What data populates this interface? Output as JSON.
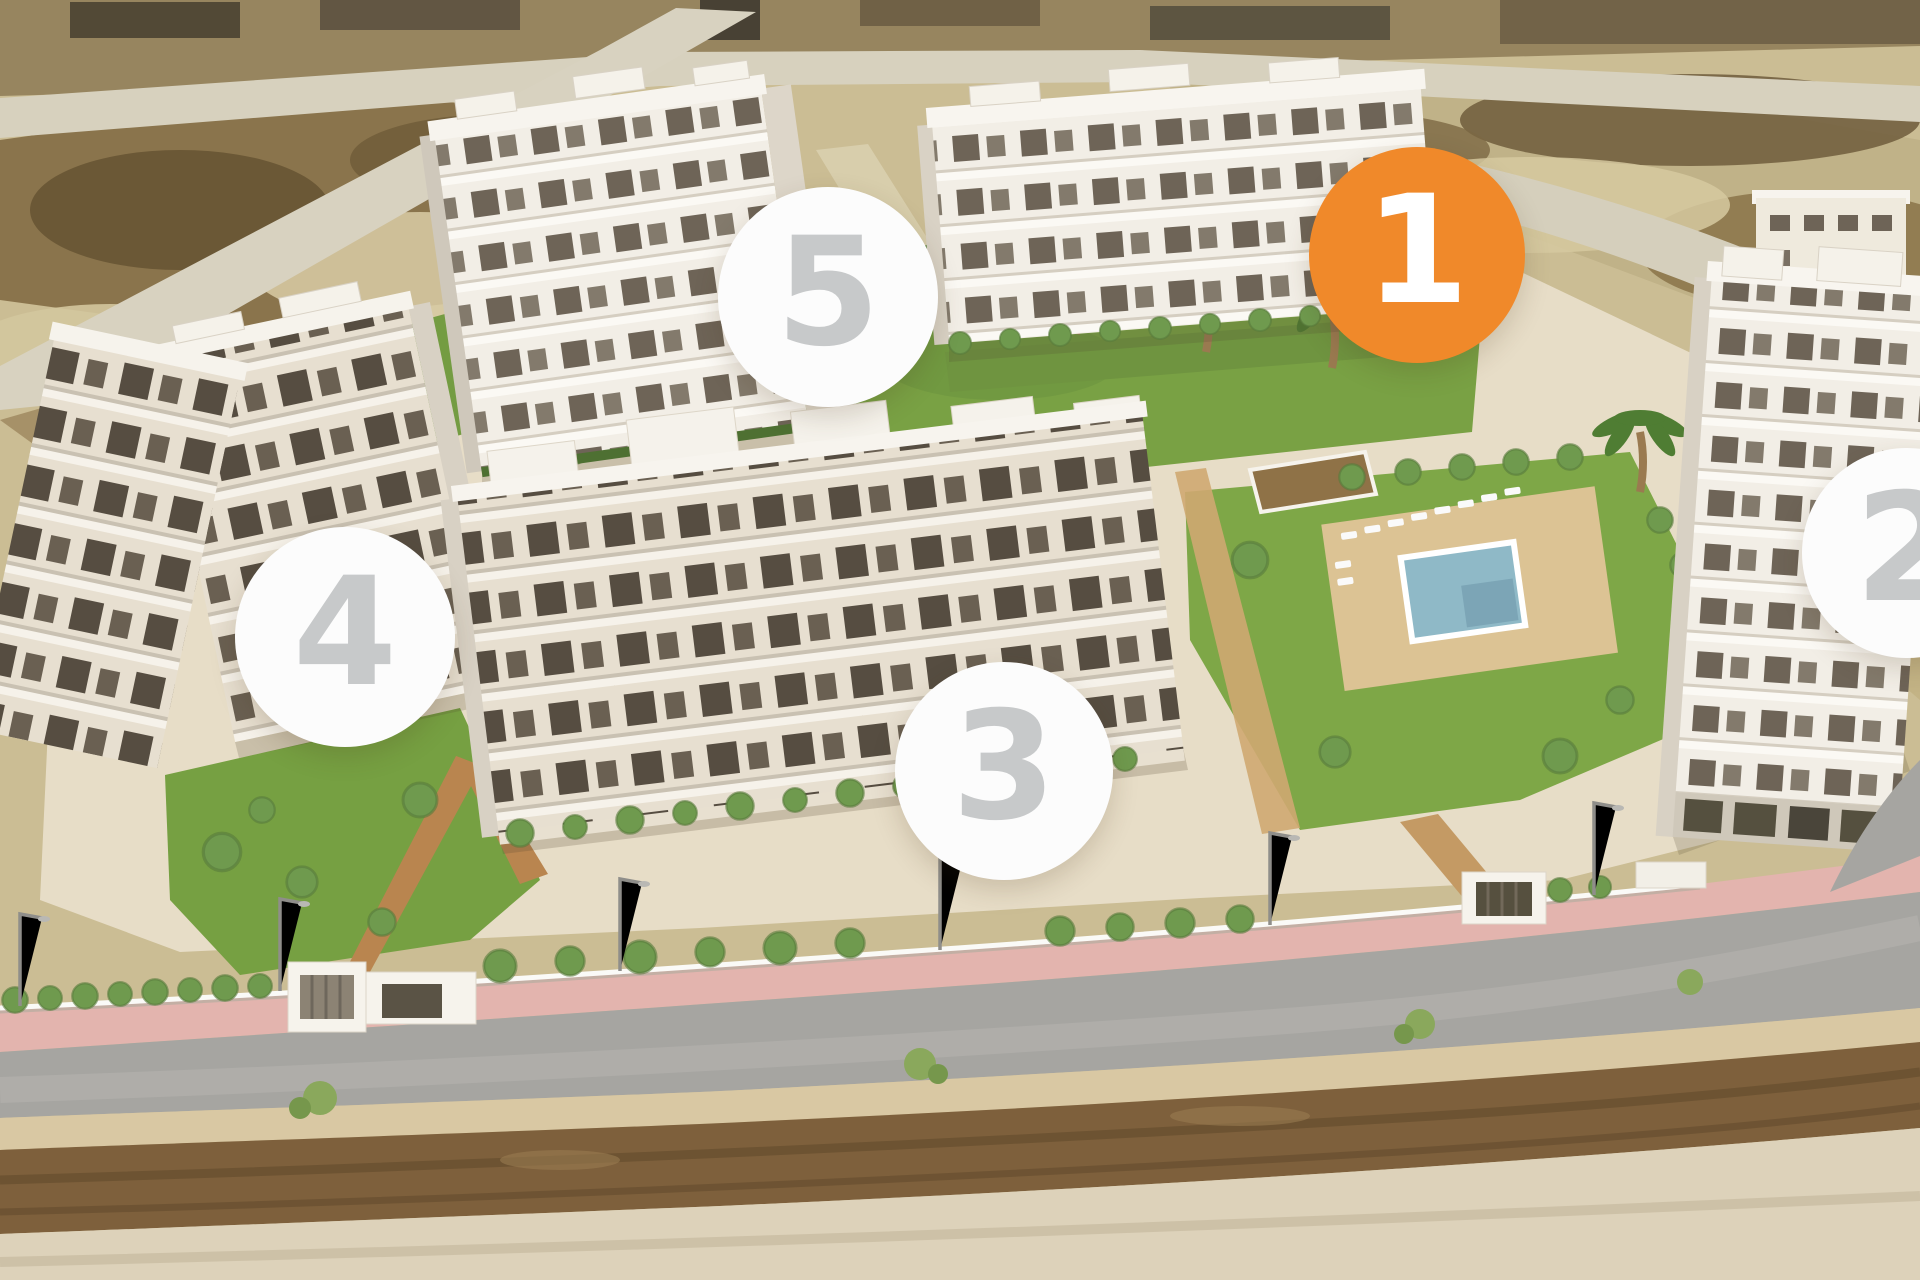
{
  "stage": {
    "width": 1920,
    "height": 1280
  },
  "palette": {
    "accent_orange": "#F0892A",
    "marker_white": "#FCFCFC",
    "marker_number_gray": "#C7C9CA",
    "lawn_green": "#79A144",
    "pool_blue": "#8FB9C7",
    "road_gray": "#A6A5A1",
    "sidewalk_pink": "#E3B4AE",
    "sand": "#CBBD94"
  },
  "markers": [
    {
      "id": "building-1",
      "number": "1",
      "selected": true,
      "bg": "#F0892A",
      "fg": "#FFFFFF",
      "cx": 1417,
      "cy": 255,
      "r": 108
    },
    {
      "id": "building-2",
      "number": "2",
      "selected": false,
      "bg": "#FCFCFC",
      "fg": "#C7C9CA",
      "cx": 1907,
      "cy": 553,
      "r": 105
    },
    {
      "id": "building-3",
      "number": "3",
      "selected": false,
      "bg": "#FCFCFC",
      "fg": "#C7C9CA",
      "cx": 1004,
      "cy": 771,
      "r": 109
    },
    {
      "id": "building-4",
      "number": "4",
      "selected": false,
      "bg": "#FCFCFC",
      "fg": "#C7C9CA",
      "cx": 345,
      "cy": 637,
      "r": 110
    },
    {
      "id": "building-5",
      "number": "5",
      "selected": false,
      "bg": "#FCFCFC",
      "fg": "#C7C9CA",
      "cx": 828,
      "cy": 297,
      "r": 110
    }
  ]
}
